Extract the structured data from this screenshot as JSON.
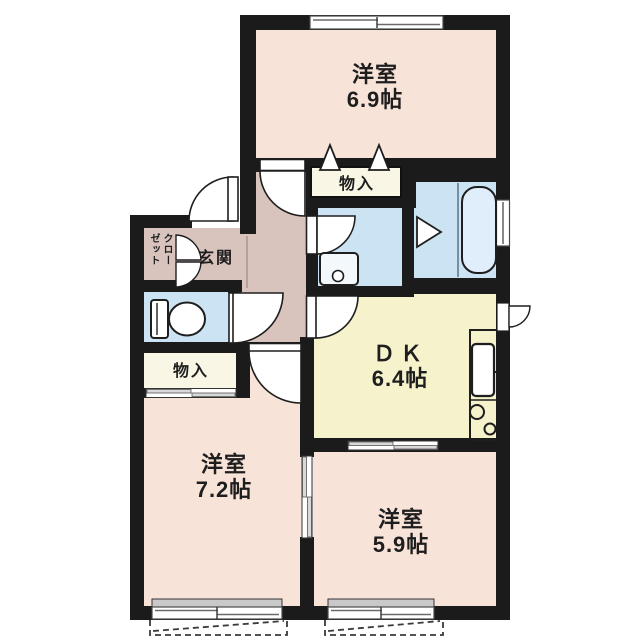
{
  "plan_title": "2LDK apartment floor plan",
  "colors": {
    "wall": "#1b1b1b",
    "western_room": "#f8e3d8",
    "dining_kitchen": "#f5f2cc",
    "wet_area": "#cbe3f2",
    "hallway": "#d8c3bd",
    "storage": "#faf6e6",
    "window": "#ffffff",
    "fixture": "#ffffff",
    "bathtub_fill": "#dfeefa",
    "balcony_line": "#3a3a3a"
  },
  "rooms": {
    "western1": {
      "name": "洋室",
      "size": "6.9帖"
    },
    "western2": {
      "name": "洋室",
      "size": "7.2帖"
    },
    "western3": {
      "name": "洋室",
      "size": "5.9帖"
    },
    "dk": {
      "name": "ＤＫ",
      "size": "6.4帖"
    },
    "entrance": {
      "name": "玄関"
    },
    "closet": {
      "name": "クローゼット"
    },
    "storage_top": {
      "name": "物入"
    },
    "storage_left": {
      "name": "物入"
    }
  },
  "fixtures": {
    "toilet": "toilet-icon",
    "bathtub": "bathtub-icon",
    "washbasin": "washbasin-icon",
    "kitchen_sink": "kitchen-sink-icon",
    "stove": "stove-burners-icon",
    "doors": "door-swing-icon",
    "folding_doors": "folding-door-icon",
    "sliding_doors": "sliding-door-icon",
    "windows": "window-icon",
    "balcony": "balcony-outline-icon"
  }
}
